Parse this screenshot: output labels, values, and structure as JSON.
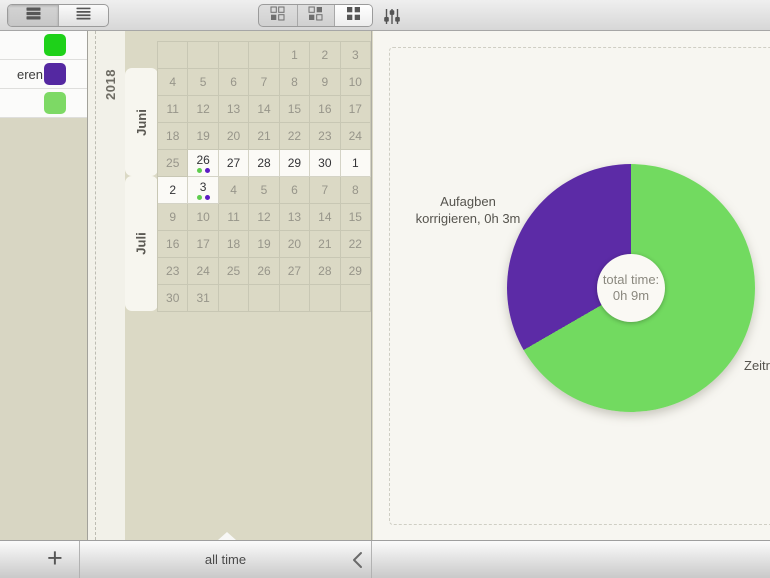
{
  "toolbar": {
    "left_segments": [
      {
        "icon": "list-rows-icon",
        "selected": true
      },
      {
        "icon": "list-lines-icon",
        "selected": false
      }
    ],
    "right_segments": [
      {
        "icon": "grid-one-filled-icon",
        "selected": false
      },
      {
        "icon": "grid-two-filled-icon",
        "selected": false
      },
      {
        "icon": "grid-all-filled-icon",
        "selected": true
      }
    ],
    "filter_icon": "sliders-icon"
  },
  "sidebar": {
    "rows": [
      {
        "label": "",
        "color": "#1ed119"
      },
      {
        "label": "eren",
        "color": "#5428a1"
      },
      {
        "label": "",
        "color": "#7dd965"
      }
    ]
  },
  "calendar": {
    "year": "2018",
    "dot_colors": [
      "#5ecd4d",
      "#5c1cc4"
    ],
    "months": [
      {
        "name": "Juni",
        "weeks": [
          [
            {
              "d": ""
            },
            {
              "d": ""
            },
            {
              "d": ""
            },
            {
              "d": ""
            },
            {
              "d": "1"
            },
            {
              "d": "2"
            },
            {
              "d": "3"
            }
          ],
          [
            {
              "d": "4"
            },
            {
              "d": "5"
            },
            {
              "d": "6"
            },
            {
              "d": "7"
            },
            {
              "d": "8"
            },
            {
              "d": "9"
            },
            {
              "d": "10"
            }
          ],
          [
            {
              "d": "11"
            },
            {
              "d": "12"
            },
            {
              "d": "13"
            },
            {
              "d": "14"
            },
            {
              "d": "15"
            },
            {
              "d": "16"
            },
            {
              "d": "17"
            }
          ],
          [
            {
              "d": "18"
            },
            {
              "d": "19"
            },
            {
              "d": "20"
            },
            {
              "d": "21"
            },
            {
              "d": "22"
            },
            {
              "d": "23"
            },
            {
              "d": "24"
            }
          ],
          [
            {
              "d": "25"
            },
            {
              "d": "26",
              "active": true,
              "dots": true
            },
            {
              "d": "27",
              "active": true
            },
            {
              "d": "28",
              "active": true
            },
            {
              "d": "29",
              "active": true
            },
            {
              "d": "30",
              "active": true
            },
            {
              "d": "1",
              "active": true
            }
          ]
        ]
      },
      {
        "name": "Juli",
        "weeks": [
          [
            {
              "d": "2",
              "active": true
            },
            {
              "d": "3",
              "active": true,
              "dots": true
            },
            {
              "d": "4"
            },
            {
              "d": "5"
            },
            {
              "d": "6"
            },
            {
              "d": "7"
            },
            {
              "d": "8"
            }
          ],
          [
            {
              "d": "9"
            },
            {
              "d": "10"
            },
            {
              "d": "11"
            },
            {
              "d": "12"
            },
            {
              "d": "13"
            },
            {
              "d": "14"
            },
            {
              "d": "15"
            }
          ],
          [
            {
              "d": "16"
            },
            {
              "d": "17"
            },
            {
              "d": "18"
            },
            {
              "d": "19"
            },
            {
              "d": "20"
            },
            {
              "d": "21"
            },
            {
              "d": "22"
            }
          ],
          [
            {
              "d": "23"
            },
            {
              "d": "24"
            },
            {
              "d": "25"
            },
            {
              "d": "26"
            },
            {
              "d": "27"
            },
            {
              "d": "28"
            },
            {
              "d": "29"
            }
          ],
          [
            {
              "d": "30"
            },
            {
              "d": "31"
            },
            {
              "d": ""
            },
            {
              "d": ""
            },
            {
              "d": ""
            },
            {
              "d": ""
            },
            {
              "d": ""
            }
          ]
        ]
      }
    ]
  },
  "chart": {
    "pie": {
      "center_line1": "total time:",
      "center_line2": "0h 9m",
      "left_callout_line1": "Aufagben",
      "left_callout_line2": "korrigieren, 0h 3m",
      "right_callout": "Zeitr",
      "slices": [
        {
          "label": "Zeitr",
          "minutes": 6,
          "color": "#72da60"
        },
        {
          "label": "Aufagben korrigieren, 0h 3m",
          "minutes": 3,
          "color": "#5c2ba6"
        }
      ]
    }
  },
  "chart_data": {
    "type": "pie",
    "title": "total time: 0h 9m",
    "slices": [
      {
        "label": "Zeitr…",
        "value_minutes": 6,
        "color": "#72da60"
      },
      {
        "label": "Aufagben korrigieren",
        "value_minutes": 3,
        "color": "#5c2ba6"
      }
    ],
    "center_text": "total time: 0h 9m",
    "legend_position": "callouts"
  },
  "footer": {
    "add_label": "+",
    "range_label": "all time",
    "prev_icon": "chevron-left-icon"
  }
}
